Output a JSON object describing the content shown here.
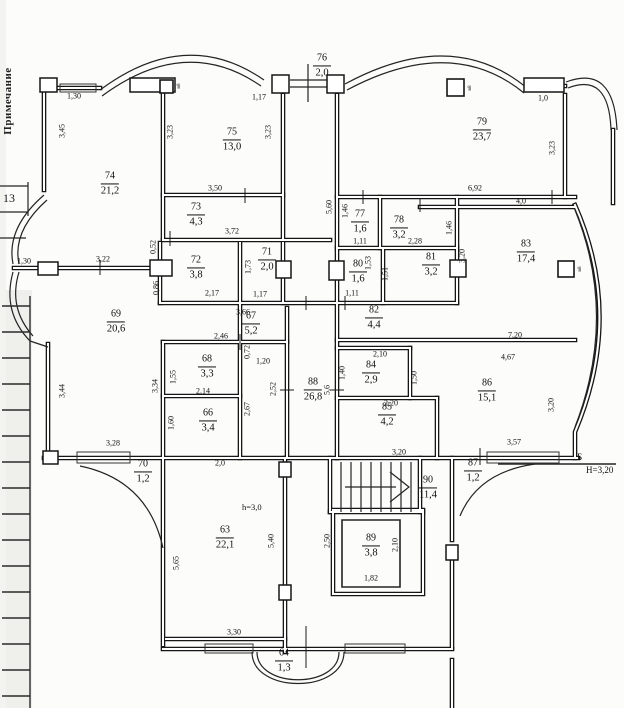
{
  "margin": {
    "note_vertical": "Примечание",
    "fragment_number": "13"
  },
  "annotations": {
    "height_label": "h=3,0",
    "axis_letter": "Б",
    "axis_height": "Н=3,20",
    "vent_label": "в8"
  },
  "rooms": [
    {
      "num": "74",
      "area": "21,2",
      "x": 110,
      "y": 184
    },
    {
      "num": "75",
      "area": "13,0",
      "x": 232,
      "y": 140
    },
    {
      "num": "76",
      "area": "2,0",
      "x": 322,
      "y": 66
    },
    {
      "num": "79",
      "area": "23,7",
      "x": 482,
      "y": 130
    },
    {
      "num": "73",
      "area": "4,3",
      "x": 196,
      "y": 215
    },
    {
      "num": "77",
      "area": "1,6",
      "x": 360,
      "y": 222
    },
    {
      "num": "78",
      "area": "3,2",
      "x": 399,
      "y": 228
    },
    {
      "num": "71",
      "area": "2,0",
      "x": 267,
      "y": 260
    },
    {
      "num": "72",
      "area": "3,8",
      "x": 196,
      "y": 268
    },
    {
      "num": "80",
      "area": "1,6",
      "x": 358,
      "y": 272
    },
    {
      "num": "81",
      "area": "3,2",
      "x": 431,
      "y": 265
    },
    {
      "num": "83",
      "area": "17,4",
      "x": 526,
      "y": 252
    },
    {
      "num": "69",
      "area": "20,6",
      "x": 116,
      "y": 322
    },
    {
      "num": "67",
      "area": "5,2",
      "x": 251,
      "y": 324
    },
    {
      "num": "82",
      "area": "4,4",
      "x": 374,
      "y": 318
    },
    {
      "num": "68",
      "area": "3,3",
      "x": 207,
      "y": 367
    },
    {
      "num": "84",
      "area": "2,9",
      "x": 371,
      "y": 373
    },
    {
      "num": "88",
      "area": "26,8",
      "x": 313,
      "y": 390
    },
    {
      "num": "86",
      "area": "15,1",
      "x": 487,
      "y": 391
    },
    {
      "num": "66",
      "area": "3,4",
      "x": 208,
      "y": 421
    },
    {
      "num": "85",
      "area": "4,2",
      "x": 387,
      "y": 415
    },
    {
      "num": "70",
      "area": "1,2",
      "x": 143,
      "y": 472
    },
    {
      "num": "87",
      "area": "1,2",
      "x": 473,
      "y": 471
    },
    {
      "num": "90",
      "area": "11,4",
      "x": 428,
      "y": 488
    },
    {
      "num": "63",
      "area": "22,1",
      "x": 225,
      "y": 538
    },
    {
      "num": "89",
      "area": "3,8",
      "x": 371,
      "y": 546
    },
    {
      "num": "64",
      "area": "1,3",
      "x": 284,
      "y": 661
    }
  ],
  "dims": [
    {
      "t": "1,30",
      "x": 74,
      "y": 96,
      "r": 0
    },
    {
      "t": "1,17",
      "x": 259,
      "y": 97,
      "r": 0
    },
    {
      "t": "1,0",
      "x": 543,
      "y": 98,
      "r": 0
    },
    {
      "t": "3,50",
      "x": 215,
      "y": 188,
      "r": 0
    },
    {
      "t": "6,92",
      "x": 475,
      "y": 188,
      "r": 0
    },
    {
      "t": "4,0",
      "x": 521,
      "y": 201,
      "r": 0
    },
    {
      "t": "3,72",
      "x": 232,
      "y": 231,
      "r": 0
    },
    {
      "t": "1,11",
      "x": 360,
      "y": 241,
      "r": 0
    },
    {
      "t": "2,28",
      "x": 415,
      "y": 241,
      "r": 0
    },
    {
      "t": "3,22",
      "x": 103,
      "y": 259,
      "r": 0
    },
    {
      "t": "1,30",
      "x": 24,
      "y": 261,
      "r": 0
    },
    {
      "t": "2,17",
      "x": 212,
      "y": 293,
      "r": 0
    },
    {
      "t": "1,17",
      "x": 260,
      "y": 294,
      "r": 0
    },
    {
      "t": "1,11",
      "x": 352,
      "y": 293,
      "r": 0
    },
    {
      "t": "3,66",
      "x": 243,
      "y": 312,
      "r": 0
    },
    {
      "t": "2,46",
      "x": 221,
      "y": 336,
      "r": 0
    },
    {
      "t": "1,20",
      "x": 263,
      "y": 361,
      "r": 0
    },
    {
      "t": "2,10",
      "x": 380,
      "y": 354,
      "r": 0
    },
    {
      "t": "7,20",
      "x": 515,
      "y": 335,
      "r": 0
    },
    {
      "t": "2,14",
      "x": 203,
      "y": 391,
      "r": 0
    },
    {
      "t": "2,20",
      "x": 391,
      "y": 403,
      "r": 0
    },
    {
      "t": "4,67",
      "x": 508,
      "y": 357,
      "r": 0
    },
    {
      "t": "2,0",
      "x": 220,
      "y": 463,
      "r": 0
    },
    {
      "t": "3,28",
      "x": 113,
      "y": 443,
      "r": 0
    },
    {
      "t": "3,20",
      "x": 399,
      "y": 452,
      "r": 0
    },
    {
      "t": "3,57",
      "x": 514,
      "y": 442,
      "r": 0
    },
    {
      "t": "3,30",
      "x": 234,
      "y": 632,
      "r": 0
    },
    {
      "t": "1,82",
      "x": 371,
      "y": 578,
      "r": 0
    },
    {
      "t": "3,45",
      "x": 62,
      "y": 131,
      "r": 1
    },
    {
      "t": "3,23",
      "x": 170,
      "y": 132,
      "r": 1
    },
    {
      "t": "3,23",
      "x": 268,
      "y": 132,
      "r": 1
    },
    {
      "t": "3,23",
      "x": 552,
      "y": 148,
      "r": 1
    },
    {
      "t": "5,60",
      "x": 329,
      "y": 207,
      "r": 1
    },
    {
      "t": "1,46",
      "x": 345,
      "y": 211,
      "r": 1
    },
    {
      "t": "1,46",
      "x": 449,
      "y": 228,
      "r": 1
    },
    {
      "t": "3,20",
      "x": 462,
      "y": 256,
      "r": 1
    },
    {
      "t": "0,52",
      "x": 153,
      "y": 247,
      "r": 1
    },
    {
      "t": "0,86",
      "x": 156,
      "y": 288,
      "r": 1
    },
    {
      "t": "1,73",
      "x": 248,
      "y": 267,
      "r": 1
    },
    {
      "t": "1,53",
      "x": 368,
      "y": 263,
      "r": 1
    },
    {
      "t": "1,51",
      "x": 385,
      "y": 274,
      "r": 1
    },
    {
      "t": "3,44",
      "x": 62,
      "y": 391,
      "r": 1
    },
    {
      "t": "3,34",
      "x": 155,
      "y": 386,
      "r": 1
    },
    {
      "t": "1,55",
      "x": 173,
      "y": 377,
      "r": 1
    },
    {
      "t": "1,60",
      "x": 171,
      "y": 423,
      "r": 1
    },
    {
      "t": "0,72",
      "x": 247,
      "y": 352,
      "r": 1
    },
    {
      "t": "2,52",
      "x": 273,
      "y": 389,
      "r": 1
    },
    {
      "t": "2,67",
      "x": 247,
      "y": 409,
      "r": 1
    },
    {
      "t": "1,40",
      "x": 342,
      "y": 373,
      "r": 1
    },
    {
      "t": "1,50",
      "x": 414,
      "y": 378,
      "r": 1
    },
    {
      "t": "3,20",
      "x": 551,
      "y": 405,
      "r": 1
    },
    {
      "t": "5,6",
      "x": 327,
      "y": 390,
      "r": 1
    },
    {
      "t": "5,65",
      "x": 176,
      "y": 563,
      "r": 1
    },
    {
      "t": "5,40",
      "x": 271,
      "y": 541,
      "r": 1
    },
    {
      "t": "2,50",
      "x": 327,
      "y": 541,
      "r": 1
    },
    {
      "t": "2,10",
      "x": 395,
      "y": 545,
      "r": 1
    }
  ],
  "vents": [
    {
      "x": 179,
      "y": 86
    },
    {
      "x": 470,
      "y": 88
    },
    {
      "x": 580,
      "y": 269
    }
  ]
}
